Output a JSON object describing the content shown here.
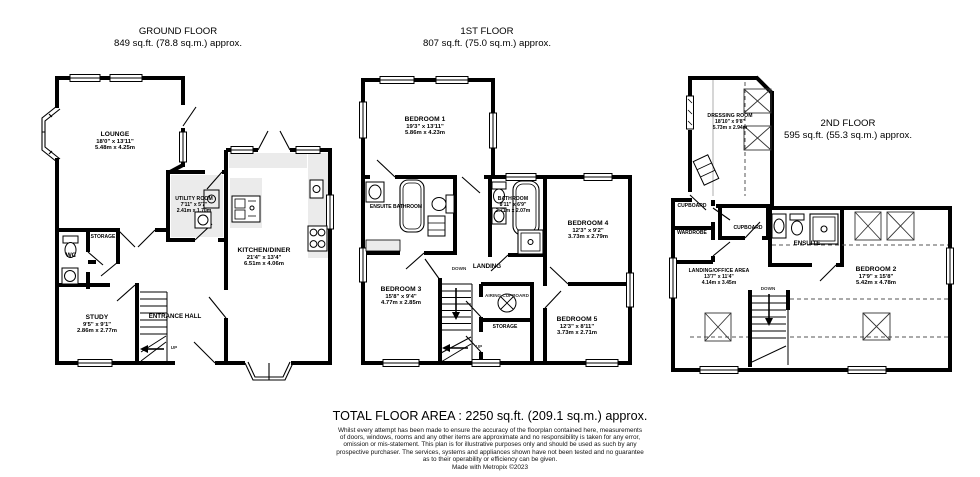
{
  "colors": {
    "wall": "#000000",
    "counter": "#ebebeb",
    "dash": "#555555"
  },
  "floors": {
    "ground": {
      "title": "GROUND FLOOR",
      "area": "849 sq.ft. (78.8 sq.m.) approx.",
      "stairs_label": "UP",
      "rooms": {
        "lounge": {
          "name": "LOUNGE",
          "imperial": "18'0\" x 13'11\"",
          "metric": "5.48m x 4.25m"
        },
        "utility": {
          "name": "UTILITY ROOM",
          "imperial": "7'11\" x 5'7\"",
          "metric": "2.41m x 1.70m"
        },
        "kitchen": {
          "name": "KITCHEN/DINER",
          "imperial": "21'4\" x 13'4\"",
          "metric": "6.51m x 4.06m"
        },
        "wc": {
          "name": "WC"
        },
        "storage": {
          "name": "STORAGE"
        },
        "study": {
          "name": "STUDY",
          "imperial": "9'5\" x 9'1\"",
          "metric": "2.86m x 2.77m"
        },
        "entrance": {
          "name": "ENTRANCE HALL"
        }
      }
    },
    "first": {
      "title": "1ST FLOOR",
      "area": "807 sq.ft. (75.0 sq.m.) approx.",
      "down_label": "DOWN",
      "up_label": "UP",
      "rooms": {
        "bedroom1": {
          "name": "BEDROOM 1",
          "imperial": "19'3\" x 13'11\"",
          "metric": "5.86m x 4.23m"
        },
        "ensuite_bathroom": {
          "name": "ENSUITE BATHROOM"
        },
        "bathroom": {
          "name": "BATHROOM",
          "imperial": "8'11\" x 6'9\"",
          "metric": "2.71m x 2.07m"
        },
        "bedroom4": {
          "name": "BEDROOM 4",
          "imperial": "12'3\" x 9'2\"",
          "metric": "3.73m x 2.79m"
        },
        "landing": {
          "name": "LANDING"
        },
        "bedroom3": {
          "name": "BEDROOM 3",
          "imperial": "15'8\" x 9'4\"",
          "metric": "4.77m x 2.85m"
        },
        "airing": {
          "name": "AIRING CUPBOARD"
        },
        "storage": {
          "name": "STORAGE"
        },
        "bedroom5": {
          "name": "BEDROOM 5",
          "imperial": "12'3\" x 8'11\"",
          "metric": "3.73m x 2.71m"
        }
      }
    },
    "second": {
      "title": "2ND FLOOR",
      "area": "595 sq.ft. (55.3 sq.m.) approx.",
      "down_label": "DOWN",
      "rooms": {
        "dressing": {
          "name": "DRESSING ROOM",
          "imperial": "18'10\" x 9'8\"",
          "metric": "5.73m x 2.94m"
        },
        "cupboard1": {
          "name": "CUPBOARD"
        },
        "wardrobe": {
          "name": "WARDROBE"
        },
        "cupboard2": {
          "name": "CUPBOARD"
        },
        "ensuite": {
          "name": "ENSUITE"
        },
        "landing_office": {
          "name": "LANDING/OFFICE AREA",
          "imperial": "13'7\" x 11'4\"",
          "metric": "4.14m x 3.45m"
        },
        "bedroom2": {
          "name": "BEDROOM 2",
          "imperial": "17'9\" x 15'8\"",
          "metric": "5.42m x 4.78m"
        }
      }
    }
  },
  "footer": {
    "total": "TOTAL FLOOR AREA : 2250 sq.ft. (209.1 sq.m.) approx.",
    "disclaimer_lines": [
      "Whilst every attempt has been made to ensure the accuracy of the floorplan contained here, measurements",
      "of doors, windows, rooms and any other items are approximate and no responsibility is taken for any error,",
      "omission or mis-statement. This plan is for illustrative purposes only and should be used as such by any",
      "prospective purchaser. The services, systems and appliances shown have not been tested and no guarantee",
      "as to their operability or efficiency can be given."
    ],
    "credit": "Made with Metropix ©2023"
  }
}
